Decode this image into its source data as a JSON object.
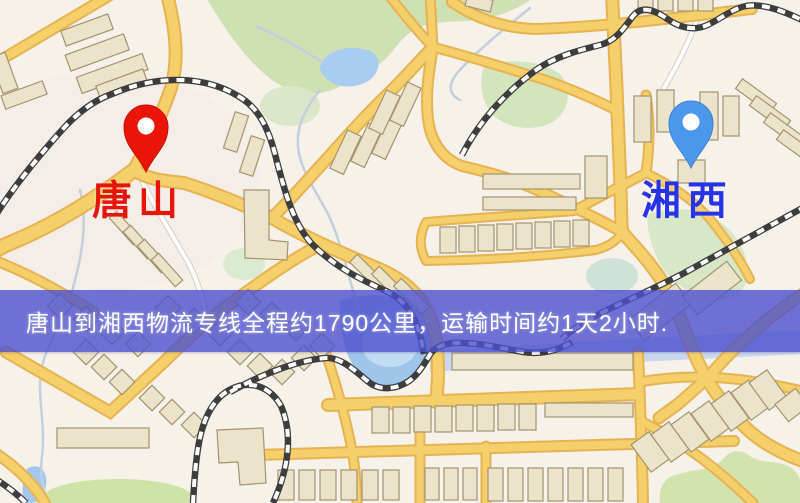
{
  "banner": {
    "text": "唐山到湘西物流专线全程约1790公里，运输时间约1天2小时."
  },
  "origin": {
    "label": "唐山",
    "pin_color": "#ea1408",
    "pin_stroke": "#c41006",
    "label_color": "#e8150a"
  },
  "destination": {
    "label": "湘西",
    "pin_color": "#4b97ec",
    "pin_stroke": "#3f83d6",
    "label_color": "#2733e6"
  },
  "map_colors": {
    "background": "#f6f1e9",
    "road_fill": "#f5cf6a",
    "road_casing": "#e5b352",
    "minor_road": "#ffffff",
    "park": "#cfe0b2",
    "water": "#a9cdf0",
    "building_fill": "#ece3cb",
    "building_stroke": "#a2946f",
    "railway_dark": "#3d3d3d",
    "banner_overlay": "#4c50ce",
    "banner_text": "#ffffff"
  }
}
